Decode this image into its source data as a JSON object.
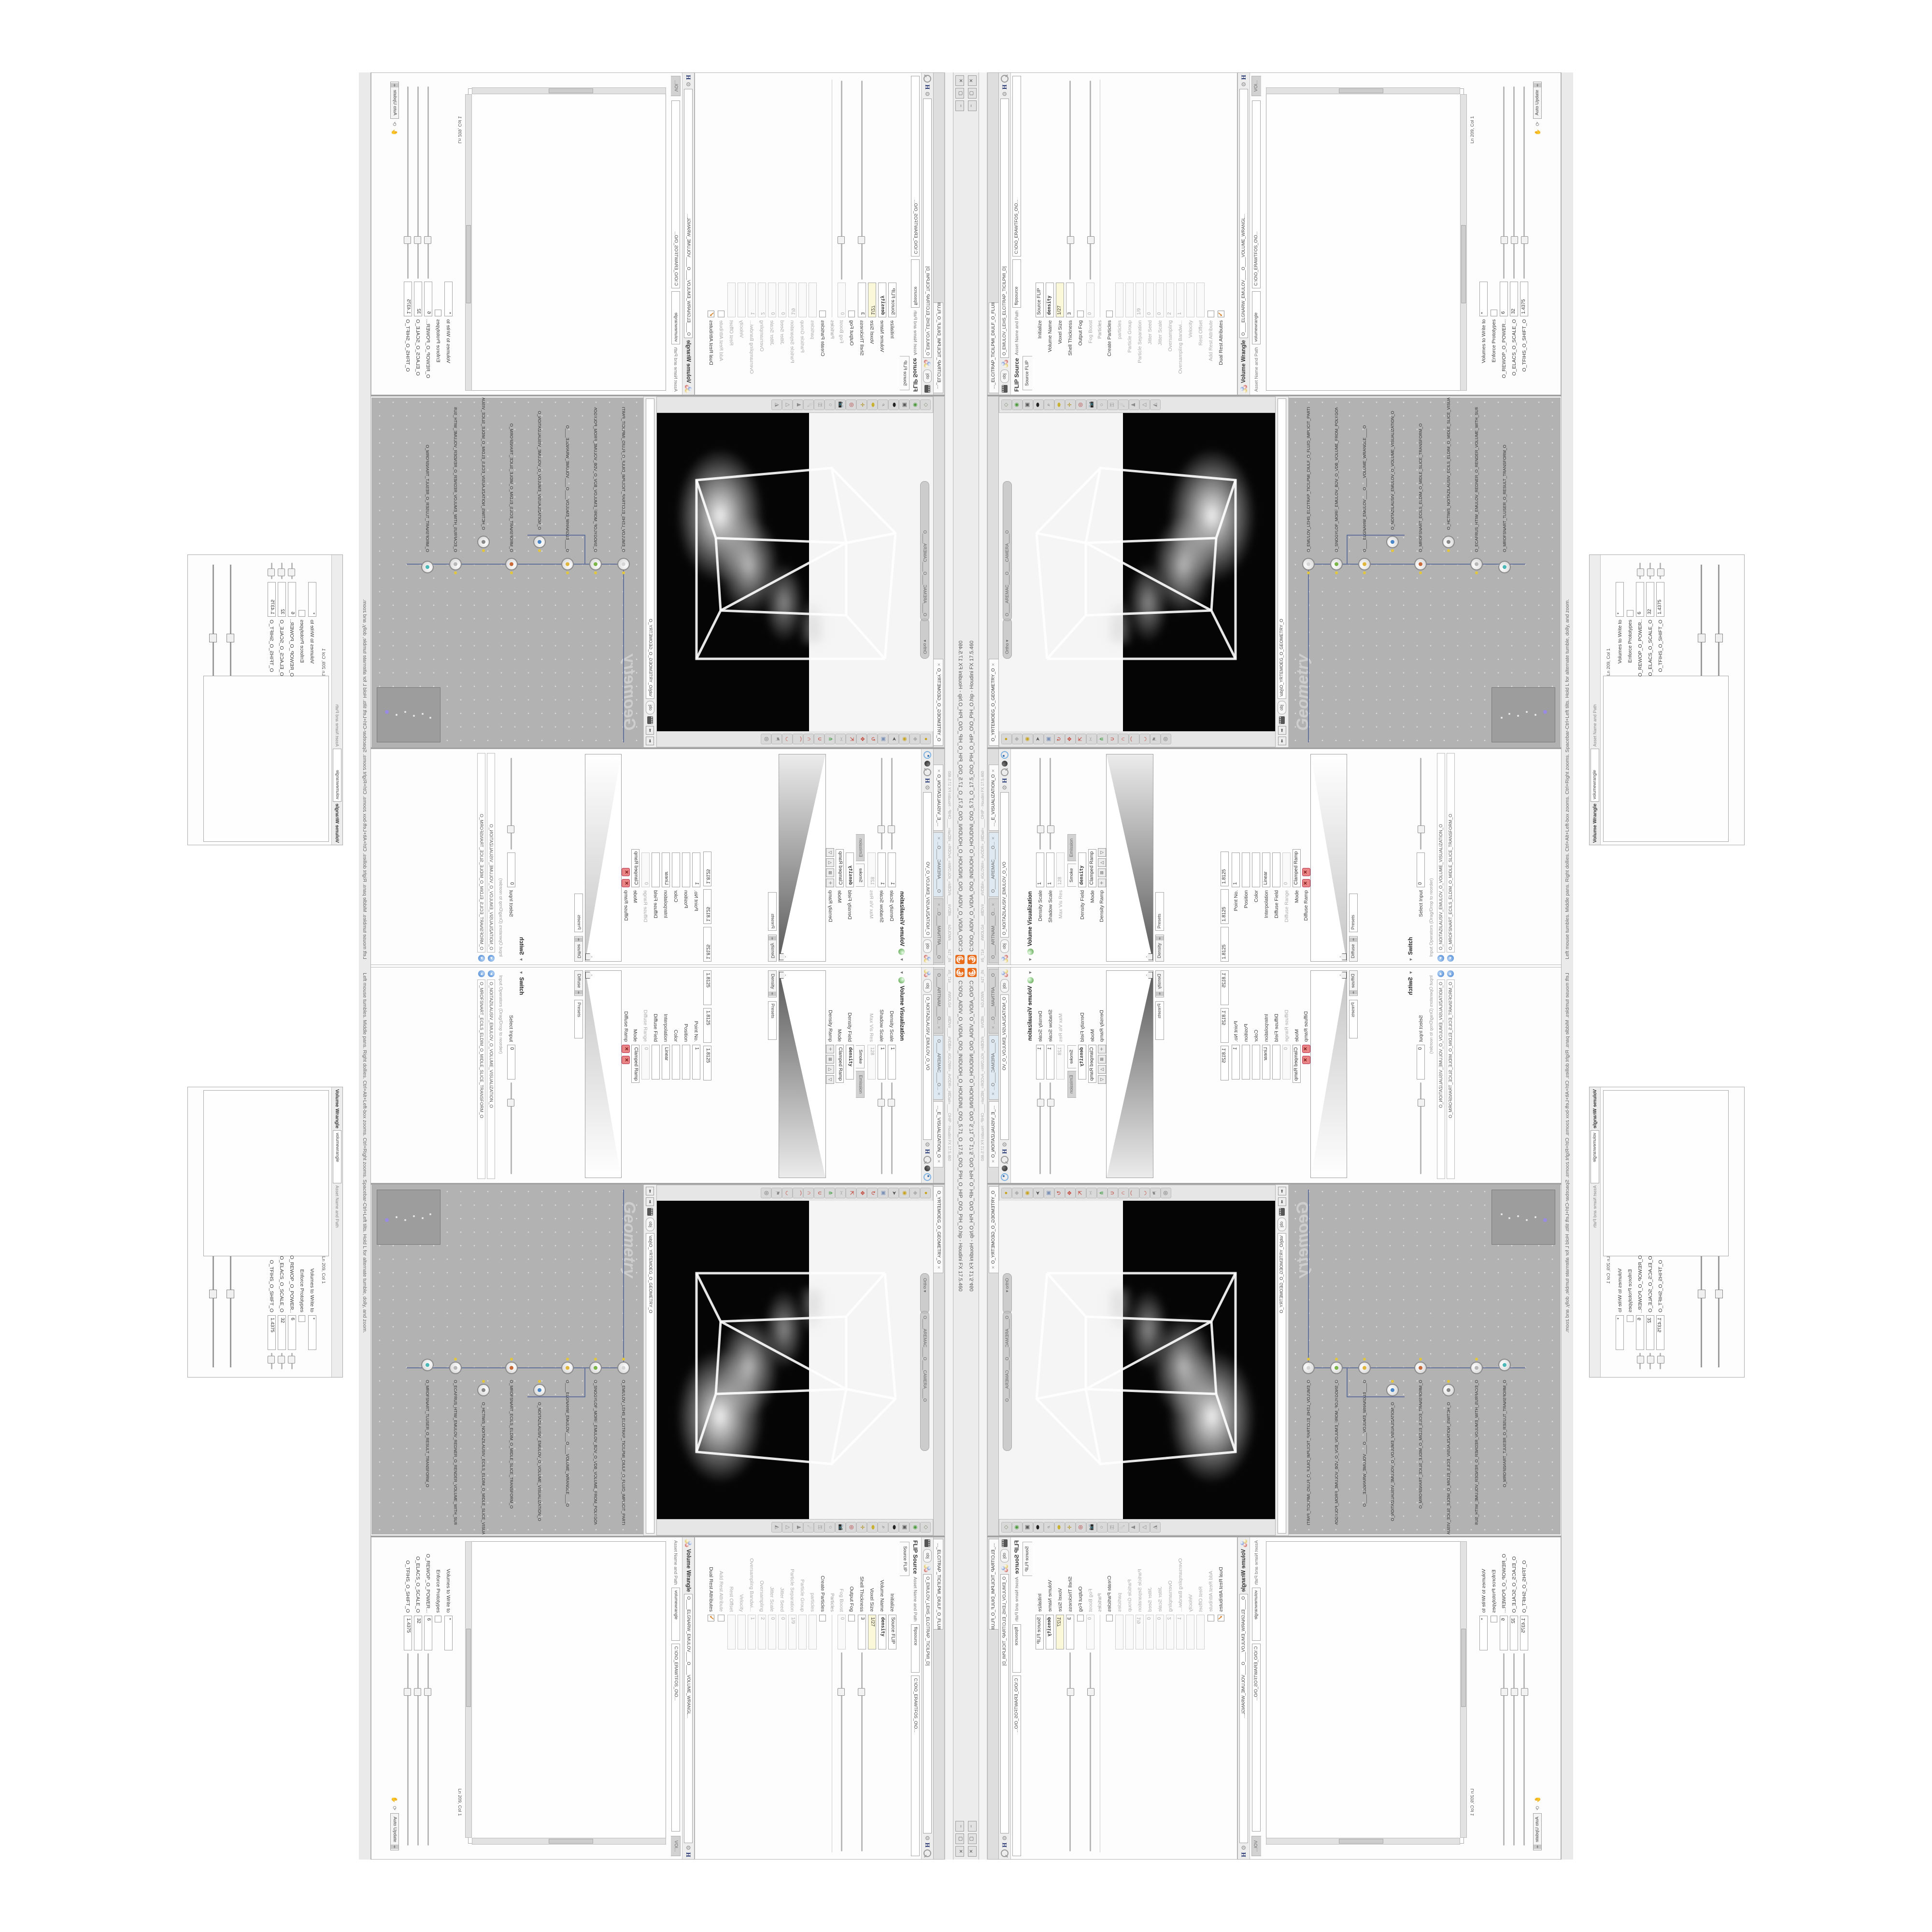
{
  "window": {
    "title": "C:\\O\\O_AIDIV_O_VIDIA_O\\O_INIDUOH_O_HOUDINI_O\\O_5.71_O_17.5_O\\O_PIH_O_HIP_O\\O_PIH_O.hip - Houdini FX 17.5.460",
    "subbar_flags": "#5_71#____#WOLG#____#8DV#____#VDB#=_#GLOW#=_#vODR=_#8Da#=____OHIP - Houdini FX 17.5.460",
    "btn_min": "−",
    "btn_max": "▢",
    "btn_close": "✕",
    "status_help": "Left mouse tumbles.  Middle pans.  Right dollies.  Ctrl+Alt+Left-box zooms.  Ctrl+Right zooms.  Spacebar-Ctrl+Left tilts.  Hold L for alternate tumble, dolly, and zoom."
  },
  "left_column": {
    "tabs": [
      {
        "t": "O____ARTNAM____O...",
        "x": "✕"
      },
      {
        "t": "O____AREMAC____O...",
        "x": "✕",
        "blue": true
      },
      {
        "t": "..._E_VISUALIZATION_O",
        "x": "✕",
        "active": true
      }
    ],
    "breadcrumb": "obj",
    "context_name": "O_NOITAZILAUSIV_EMULOV_O_VO",
    "volvis": {
      "title": "Volume Visualization",
      "rows": [
        {
          "l": "Density Scale",
          "v": "1",
          "slider": true
        },
        {
          "l": "Shadow Scale",
          "v": "1",
          "slider": true
        },
        {
          "l": "Max Vis Res",
          "v": "128",
          "dis": true
        }
      ],
      "tabs": [
        "Smoke",
        "Emission"
      ],
      "rows2": [
        {
          "l": "Density Field",
          "v": "density",
          "boldv": true
        },
        {
          "l": "Mode",
          "v": "Clamped Ramp"
        }
      ],
      "ramp_label": "Density Ramp",
      "ramp_buttons": [
        "＋",
        "⊞",
        "△",
        "▽"
      ],
      "below_ramp": [
        "Density",
        "Presets"
      ]
    },
    "volvis2": {
      "values": [
        "1.8125",
        "1.8125",
        "1.8125"
      ],
      "rows": [
        {
          "l": "Point No.",
          "v": "1"
        },
        {
          "l": "Position",
          "v": ""
        },
        {
          "l": "Color",
          "v": ""
        },
        {
          "l": "Interpolation",
          "v": "Linear"
        },
        {
          "l": "Diffuse Field",
          "v": ""
        },
        {
          "l": "Diffuse Range",
          "v": "0",
          "dis": true
        },
        {
          "l": "Mode",
          "v": "Clamped Ramp"
        }
      ],
      "ramp_label": "Diffuse Ramp",
      "below_ramp": [
        "Diffuse",
        "Presets"
      ]
    },
    "switch": {
      "title": "Switch",
      "select_input_label": "Select Input",
      "select_input_value": "0",
      "ops_label": "Input Operators (Drag/Drop to reorder)",
      "items": [
        {
          "nm": "O_NOITAZILAUSIV_EMULOV_O_VOLUME_VISUALIZATION_O"
        },
        {
          "nm": "O_MROFSNART_ECILS_ELDIM_O_MIDLE_SLICE_TRANSFORM_O"
        }
      ]
    }
  },
  "viewport": {
    "tab": "O_YRTEMOEG_O_GEOMETRY_O",
    "pill_projection": "Ortho",
    "pill_camera": "O____AREMAC____O____CAMERA____O",
    "lock_icon": "🔒",
    "left_icons": [
      {
        "g": "●",
        "c": "#c8a21a"
      },
      {
        "g": "◆",
        "c": "#b0b0b0"
      },
      {
        "g": "◉",
        "c": "#c8a21a"
      },
      {
        "g": "➤",
        "c": "#555555"
      },
      {
        "g": "▣",
        "c": "#7a92b8"
      },
      {
        "g": "↻",
        "c": "#c0392b"
      },
      {
        "g": "✥",
        "c": "#c0392b"
      },
      {
        "g": "⇱",
        "c": "#c0392b"
      },
      {
        "g": "✂",
        "c": "#aaaaaa"
      },
      {
        "g": "⋔",
        "c": "#3a9a3a"
      },
      {
        "g": "∪",
        "c": "#c0392b"
      },
      {
        "g": "∩",
        "c": "#c0392b"
      },
      {
        "g": "⌒",
        "c": "#c0392b"
      },
      {
        "g": "◡",
        "c": "#c0392b"
      },
      {
        "g": "⚑",
        "c": "#888888"
      },
      {
        "g": "◎",
        "c": "#666666"
      }
    ],
    "right_icons": [
      {
        "g": "◇",
        "c": "#7a8a6a"
      },
      {
        "g": "◉",
        "c": "#4a9a3a"
      },
      {
        "g": "▣",
        "c": "#5a5a5a"
      },
      {
        "g": "⬬",
        "c": "#222222"
      },
      {
        "g": "⌕",
        "c": "#666666"
      },
      {
        "g": "⬬",
        "c": "#c8b030"
      },
      {
        "g": "✛",
        "c": "#b09020"
      },
      {
        "g": "◎",
        "c": "#b03030"
      },
      {
        "g": "📷",
        "c": "#777777"
      },
      {
        "g": "○",
        "c": "#888888"
      },
      {
        "g": "⚿",
        "c": "#888888"
      },
      {
        "g": "☄",
        "c": "#888888"
      },
      {
        "g": "♟",
        "c": "#888888"
      },
      {
        "g": "△",
        "c": "#888888"
      },
      {
        "g": "◭",
        "c": "#888888"
      }
    ]
  },
  "network": {
    "nav_left": "⬅",
    "nav_right": "➡",
    "breadcrumb": "obj",
    "path": "\\obj\\O_YRTEMOEG_O_GEOMETRY_O",
    "watermark": "Geometry",
    "nodes": [
      {
        "nm": "O_EMULOV_LEHS_ELCITRAP_TICILPMI_DIULF_O_FLUID_IMPLICIT_PARTICLE_SHEL_VOLUME_O",
        "dot": "#d8d8d8",
        "ringed": true,
        "badge": true
      },
      {
        "nm": "O_SNOGYLOP_MORF_EMULOV_BDV_O_VDB_VOLUME_FROM_POLYGONS_O",
        "dot": "#7ab648",
        "badge": true
      },
      {
        "nm": "O____ELGNARW_EMULOV____O____VOLUME_WRANGLE____O",
        "dot": "#e0b63c",
        "badge": true
      },
      {
        "nm": "O_NOITAZILAUSIV_EMULOV_O_VOLUME_VISUALIZATION_O",
        "dot": "#4a86c8",
        "badge": true
      },
      {
        "nm": "O_MROFSNART_ECILS_ELDIM_O_MIDLE_SLICE_TRANSFORM_O",
        "dot": "#c86a3a",
        "badge": true
      },
      {
        "nm": "O_HCTIWS_NOITAZILAUSIV_ECILS_ELDIM_O_MIDLE_SLICE_VISUALIZATION_SWITCH_O",
        "dot": "#888888",
        "badge": true
      },
      {
        "nm": "O_ECAFRUS_HTIW_EMULOV_REDNER_O_RENDER_VOLUME_WITH_SURFACE_O",
        "dot": "#b8b8b8",
        "badge": true
      },
      {
        "nm": "O_MROFSNART_TLUSER_O_RESULT_TRANSFORM_O",
        "dot": "#4ab8b8",
        "seln": true,
        "selb": true
      }
    ]
  },
  "flip": {
    "tab": "..._ELCITRAP_TICILPMI_DIULF_O_FLUID_IMPLICIT_PARTICLE...",
    "breadcrumb": "obj",
    "title": "FLIP Source",
    "node_name": "O_EMULOV_LEHS_ELCITRAP_TICILPMI_D]",
    "asset_label": "Asset Name and Path",
    "asset_name": "flipsource",
    "asset_path": "C:\\O\\O_ERAWTFOS_O\\O...",
    "folder_tab": "Source FLIP",
    "rows": [
      {
        "l": "Initialize",
        "v": "Source FLIP"
      },
      {
        "l": "Volume Name",
        "v": "density",
        "boldv": true
      },
      {
        "l": "Voxel Size",
        "v": "1/27",
        "yellow": true
      },
      {
        "l": "Shell Thickness",
        "v": "3",
        "slider": true
      },
      {
        "l": "Output Fog",
        "checkbox": true
      },
      {
        "l": "Fog Boost",
        "v": "0",
        "dis": true,
        "slider": true
      },
      {
        "l": "Particles",
        "sep": true
      },
      {
        "l": "Create Particles",
        "checkbox": true
      },
      {
        "l": "particles",
        "v": "",
        "dis": true
      },
      {
        "l": "Particle Group",
        "v": "",
        "dis": true
      },
      {
        "l": "Particle Separation",
        "v": "1/9",
        "dis": true
      },
      {
        "l": "Jitter Seed",
        "v": "0",
        "dis": true
      },
      {
        "l": "Jitter Scale",
        "v": "0",
        "dis": true
      },
      {
        "l": "Oversampling",
        "v": "2",
        "dis": true
      },
      {
        "l": "Oversampling Bandwi...",
        "v": "1",
        "dis": true
      },
      {
        "l": "Velocity",
        "v": "",
        "dis": true
      },
      {
        "l": "Rest Offset",
        "v": "",
        "dis": true
      },
      {
        "l": "Add Rest Attribute",
        "checkbox": true,
        "dis": true
      },
      {
        "l": "Dual Rest Attributes",
        "checkbox": true,
        "checked": true
      }
    ]
  },
  "wrangle": {
    "title": "Volume Wrangle",
    "node_name": "O____ELGNARW_EMULOV____O____VOLUME_WRANGL...",
    "asset_label": "Asset Name and Path",
    "asset_name": "volumewrangle",
    "asset_path": "C:\\O\\O_ERAWTFOS_O\\O...",
    "folder_tab": "VOl...",
    "code_lines": [
      {
        "t": "\\\\\\\\  \\\\\\\\  \\\\\\\\  \\\\\\\\"
      },
      {
        "t": "@@   @@   @@   @@"
      },
      {
        "t": "0D3%steserPym62%0D3%eziSym62%000.1D3%C62%000."
      },
      {
        "t": "0D3%steserPym62%0D3%eziSym62%000.1D3%CeS%000."
      },
      {
        "t": "HTTP://MEMORYST@MP.C@M/graphtoy/#draw1%3Dtru"
      },
      {
        "t": "HTTP://MEMORYST@MP.C@M/graphtoy/#draw1%3Dtru"
      },
      {
        "t": "////"
      },
      {
        "t": ""
      },
      {
        "t": "@density=(("
      },
      {
        "t": "   ((pow(("
      },
      {
        "t": "      1./ (1.-cla"
      },
      {
        "t": ""
      },
      {
        "t": "\\\\\\\\  \\\\\\\\  \\\\\\\\  \\\\\\\\"
      },
      {
        "t": "@@   @@   @@   @@"
      },
      {
        "t": "0D3%steserPym62%0D3%eziSym62%000.1D3%C62%000."
      },
      {
        "t": "0D3%steserPym62%0D3%eziSym62%000.1D3%CeS%000."
      },
      {
        "t": "HTTP://MEMORYST@MP.C@M/graphtoy/#draw1%3Dtru"
      },
      {
        "t": "HTTP://MEMORYST@MP.C@M/graphtoy/#draw1%3Dtru"
      },
      {
        "t": "////"
      },
      {
        "t": ""
      },
      {
        "t": "\\\\\\\\  \\\\\\\\  \\\\\\\\  \\\\\\\\"
      },
      {
        "t": "@@   @@   @@   @@"
      },
      {
        "t": "0D3%steserPym62%0D3%eziSym62%000.1D3%C62%000."
      },
      {
        "t": "HTTP://MEMORYST@MP.C@M/graphtoy/#draw1%3Dtru"
      },
      {
        "t": "((pow((  1./ (1.-cla"
      },
      {
        "t": "0D3%steserPym62%0D3%eziSym62%000.1D3%C62%000."
      },
      {
        "t": "HTTP://MEMORYST@MP.C@M/graphtoy/#draw1%3Dtru"
      },
      {
        "t": "////   \\\\\\\\   @@"
      }
    ],
    "ln_status": "Ln 209, Col 1",
    "volumes_label": "Volumes to Write to",
    "volumes_value": "*",
    "enforce_label": "Enforce Prototypes",
    "params": [
      {
        "l": "O_REWOP_O_POWER...",
        "v": "6"
      },
      {
        "l": "O_ELACS_O_SCALE_O",
        "v": "32"
      },
      {
        "l": "O_TFIHS_O_SHIFT_O",
        "v": "1.4375"
      }
    ],
    "auto_update": "Auto Update"
  }
}
